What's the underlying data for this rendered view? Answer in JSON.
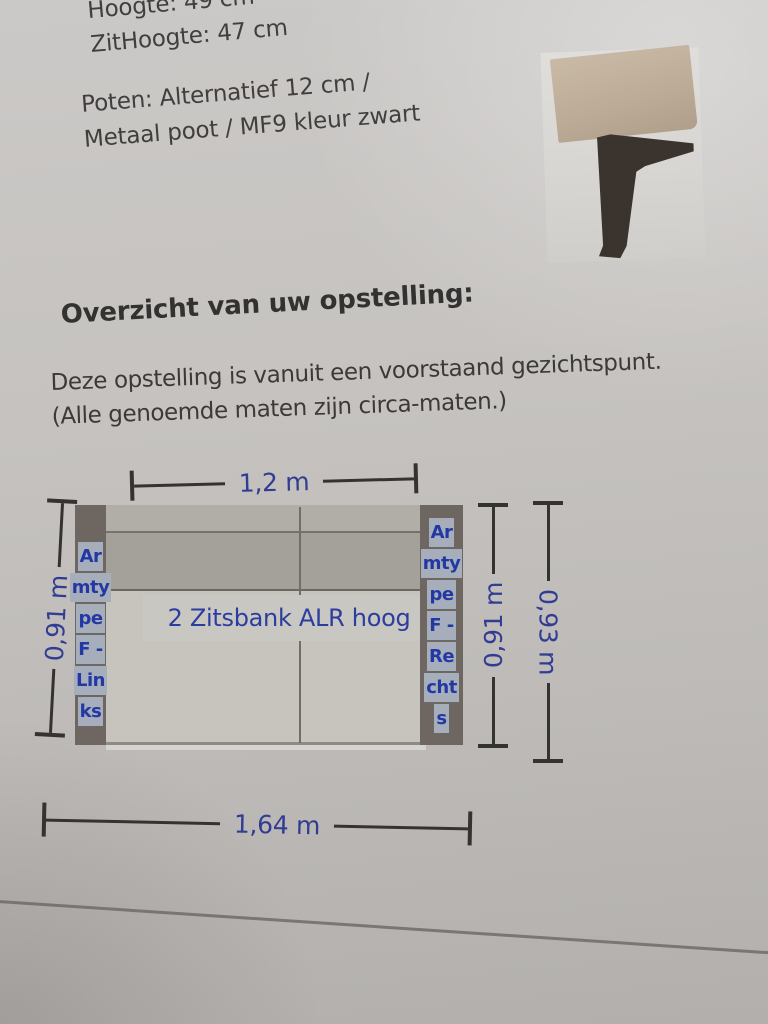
{
  "document": {
    "spec_lines": [
      "Hoogte: 49 cm",
      "ZitHoogte: 47 cm"
    ],
    "leg_lines": [
      "Poten: Alternatief 12 cm /",
      "Metaal poot / MF9 kleur zwart"
    ],
    "section_heading": "Overzicht van uw opstelling:",
    "description_lines": [
      "Deze opstelling is vanuit een voorstaand gezichtspunt.",
      "(Alle genoemde maten zijn circa-maten.)"
    ]
  },
  "diagram": {
    "sofa_label": "2 Zitsbank ALR hoog",
    "dimensions": {
      "top_width": "1,2 m",
      "bottom_width": "1,64 m",
      "left_depth": "0,91 m",
      "right_depth": "0,91 m",
      "right_total_depth": "0,93 m"
    },
    "armrest_left_lines": [
      "Ar",
      "mty",
      "pe",
      "F -",
      "Lin",
      "ks"
    ],
    "armrest_right_lines": [
      "Ar",
      "mty",
      "pe",
      "F -",
      "Re",
      "cht",
      "s"
    ],
    "colors": {
      "dimension_text": "#313c93",
      "label_text": "#2c3da0",
      "armrest_fill": "#6e6761",
      "armline_highlight": "#a6aebc",
      "seat_fill": "#c7c4bd",
      "backrest_fill": "#a4a09a",
      "dimension_line": "#35332f"
    }
  }
}
